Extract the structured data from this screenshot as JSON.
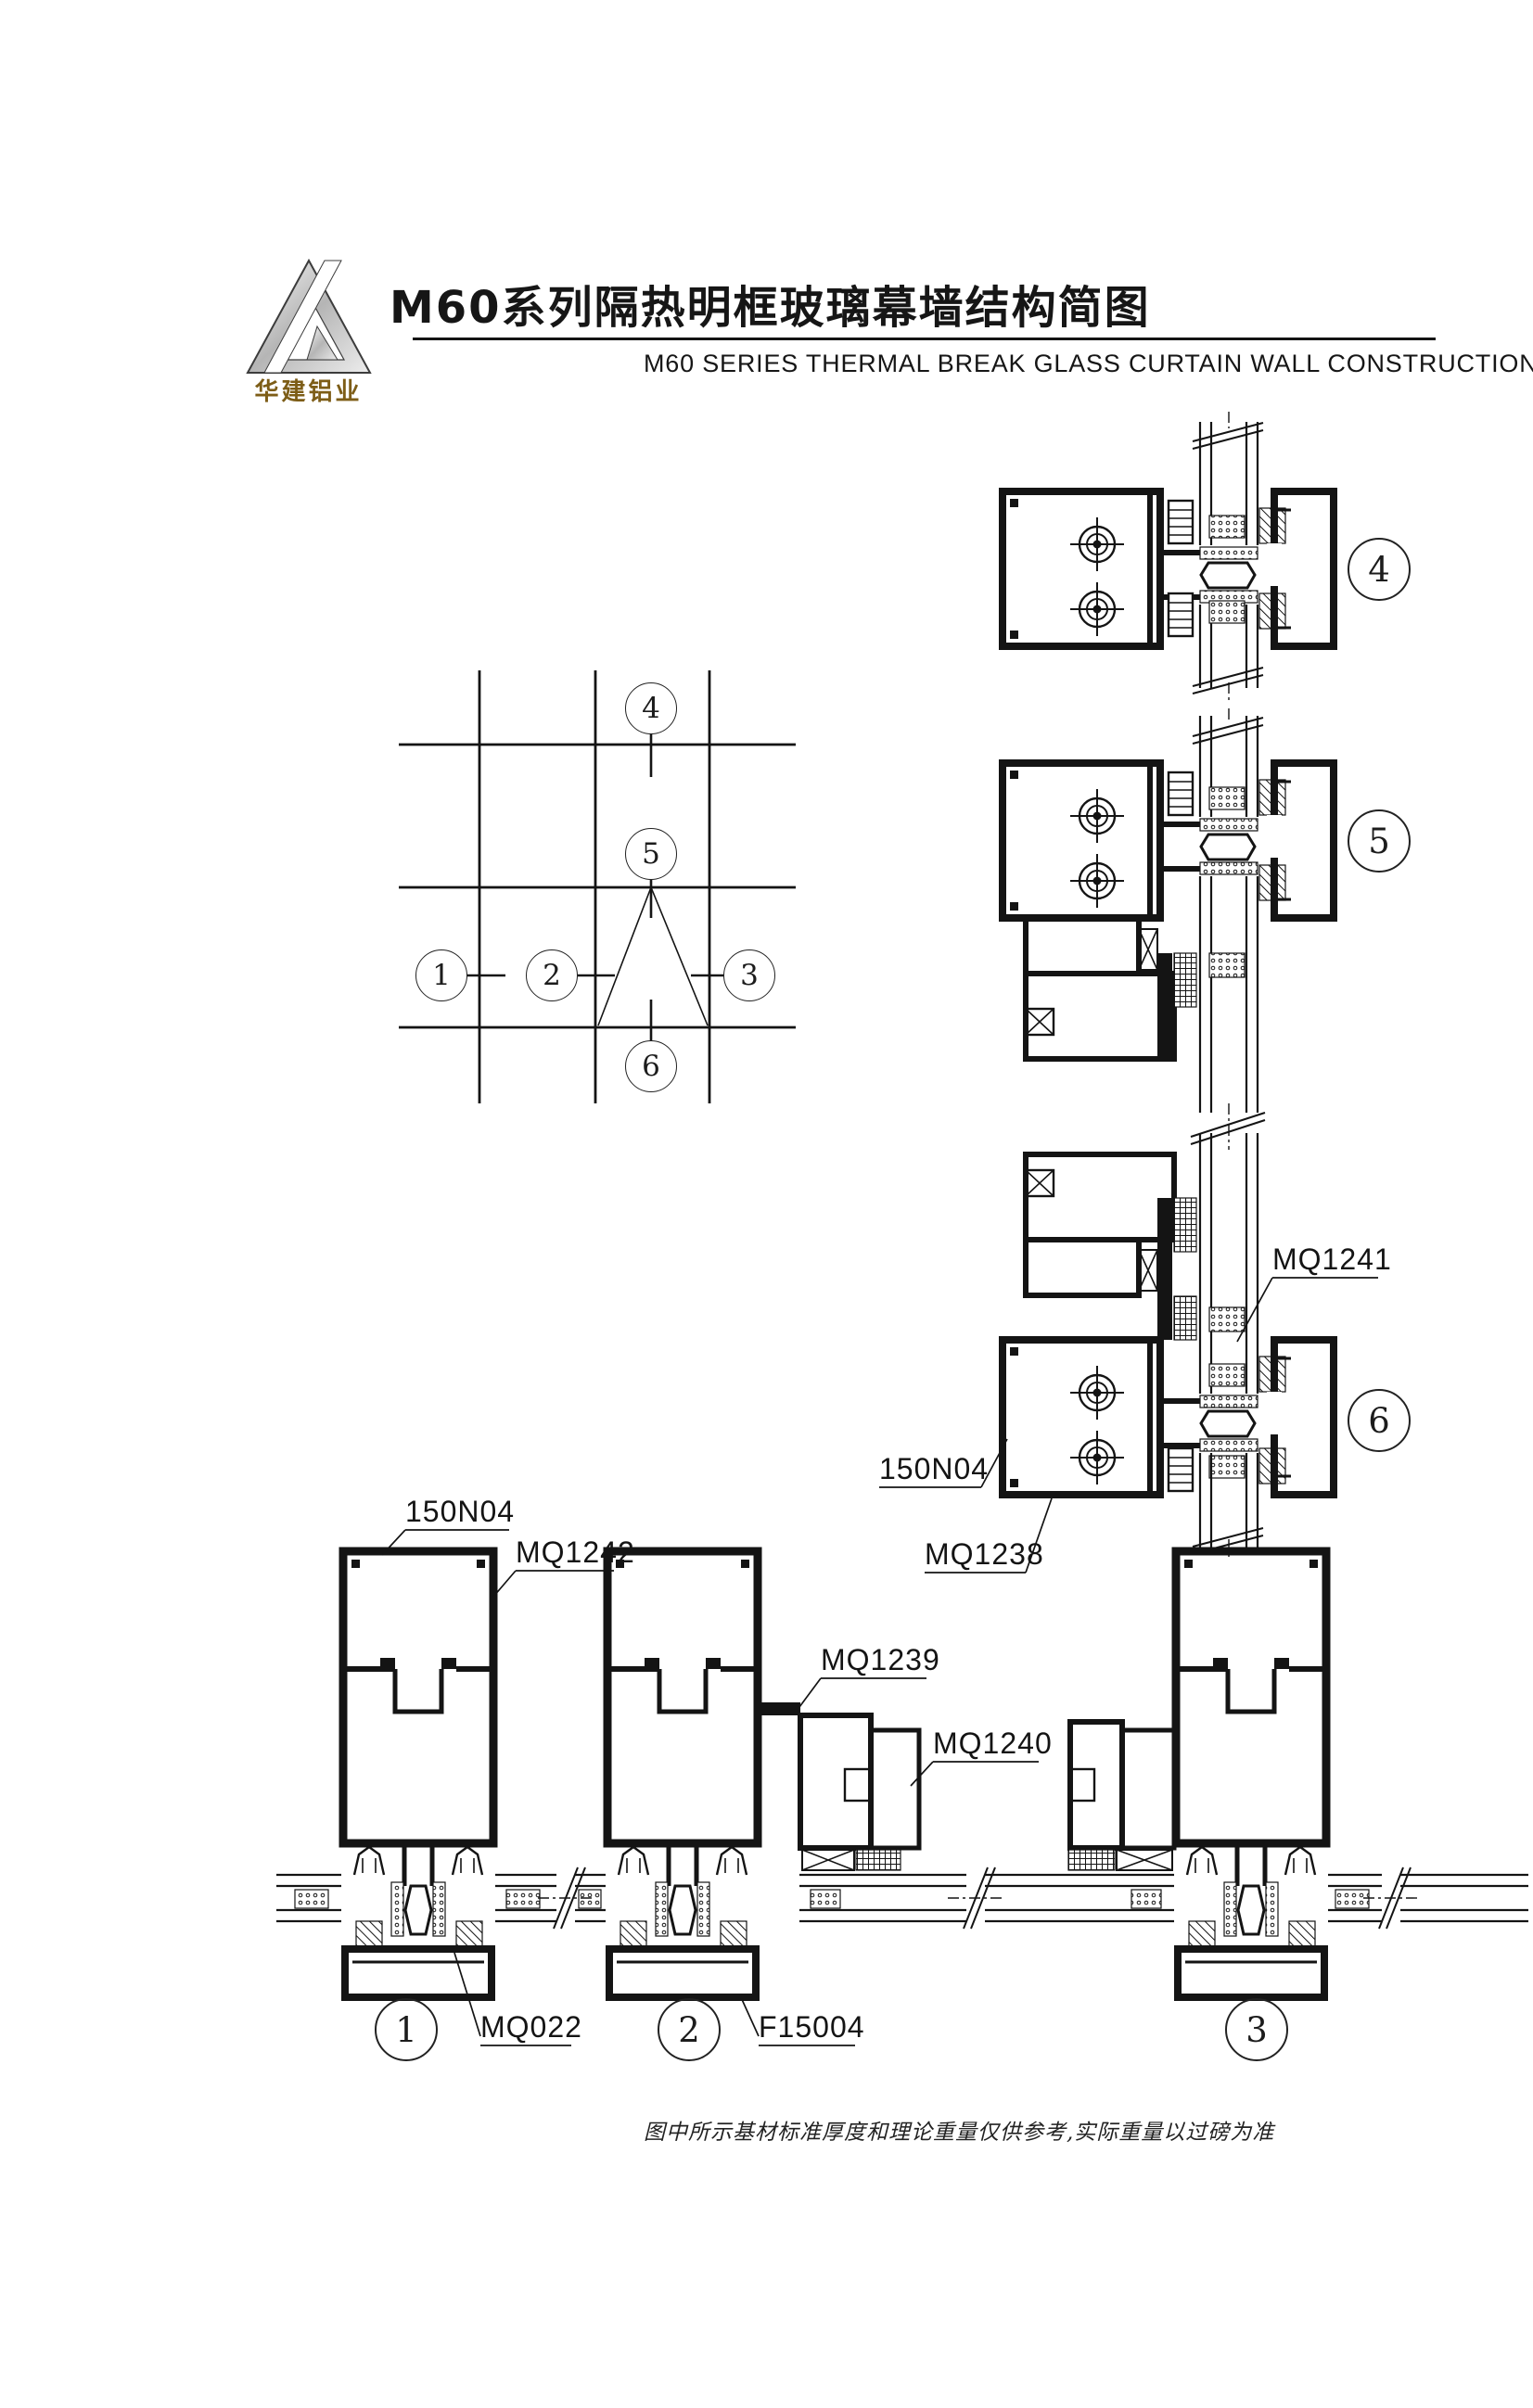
{
  "header": {
    "logo_text": "华建铝业",
    "title_cn": "M60系列隔热明框玻璃幕墙结构简图",
    "subtitle_en": "M60 SERIES THERMAL BREAK GLASS CURTAIN WALL CONSTRUCTION"
  },
  "callouts": {
    "c1": "1",
    "c2": "2",
    "c3": "3",
    "c4": "4",
    "c5": "5",
    "c6": "6"
  },
  "part_labels": {
    "n150_detail1": "150N04",
    "mq1242": "MQ1242",
    "mq1239": "MQ1239",
    "mq1240": "MQ1240",
    "mq022": "MQ022",
    "f15004": "F15004",
    "mq1241": "MQ1241",
    "n150_detail6": "150N04",
    "mq1238": "MQ1238"
  },
  "footnote": "图中所示基材标准厚度和理论重量仅供参考,实际重量以过磅为准"
}
